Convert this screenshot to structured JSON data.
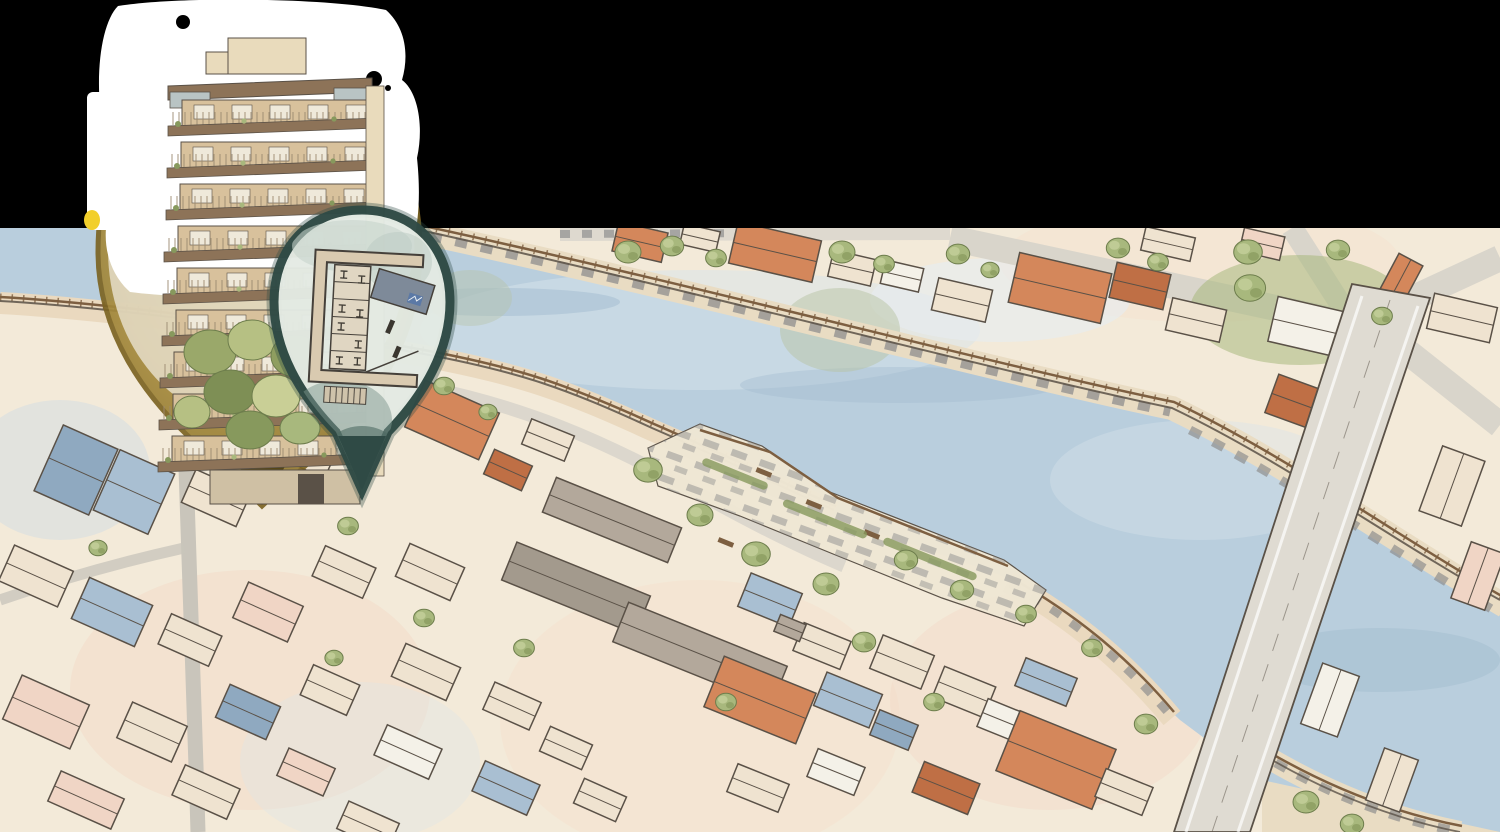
{
  "canvas": {
    "width": 1500,
    "height": 832
  },
  "scene": {
    "kind": "watercolor-aerial-map-illustration",
    "features": [
      "river",
      "riverside-promenade",
      "waterfront-plaza",
      "road-bridge",
      "city-blocks",
      "trees",
      "apartment-building-rendering",
      "site-floor-plan"
    ]
  },
  "pins": [
    {
      "name": "property-location-pin",
      "style": "amber",
      "content": "apartment-building-exterior"
    },
    {
      "name": "site-plan-pin",
      "style": "teal",
      "content": "building-floor-plan"
    }
  ],
  "colors": {
    "backdrop": "#000000",
    "land": "#f3ead9",
    "plaza": "#efe7d4",
    "water": "#b9cedd",
    "waterLight": "#d7e3ec",
    "waterDeep": "#a2bccf",
    "reflection": "#b7c3a4",
    "roadGray": "#d9d5cb",
    "bridgeGray": "#dfdbd2",
    "streetGray": "#c9c5bb",
    "promTan": "#e9dcc3",
    "promNear": "#ead9bf",
    "railBrown": "#7d5f41",
    "dashGray": "#8e8e8e",
    "ink": "#5a5147",
    "roofTerracotta": "#d4875b",
    "roofTerraDark": "#bf6f45",
    "roofBlue": "#a9bfd2",
    "roofBlueDark": "#8fa9c0",
    "roofBeige": "#efe3d0",
    "roofWhite": "#f4f1e8",
    "roofPink": "#f0d5c5",
    "roofGray": "#b3a89b",
    "roofGrayDark": "#a39a8d",
    "tree": "#a8b87d",
    "treeDark": "#87995d",
    "treeLight": "#c4d09b",
    "pinAmber": "#a78c3e",
    "pinAmberRim": "#7c6423",
    "pinAmberTip": "#4f3f12",
    "pinTeal": "#2f4a45",
    "pinTealFill": "#e4ebe4",
    "pinTealBlotch": "#7e968d",
    "halo": "#ffffff",
    "facade": "#d8c19c",
    "facadeLight": "#e9dbbc",
    "slab": "#8d7358",
    "windowPane": "#efe9da",
    "glass": "#b9c4c4",
    "planWall": "#45403a",
    "planFloor": "#e0d6c2",
    "planRoof": "#7e8a99",
    "planBlue": "#5b79a6",
    "accentYellow": "#f2cf2a"
  }
}
